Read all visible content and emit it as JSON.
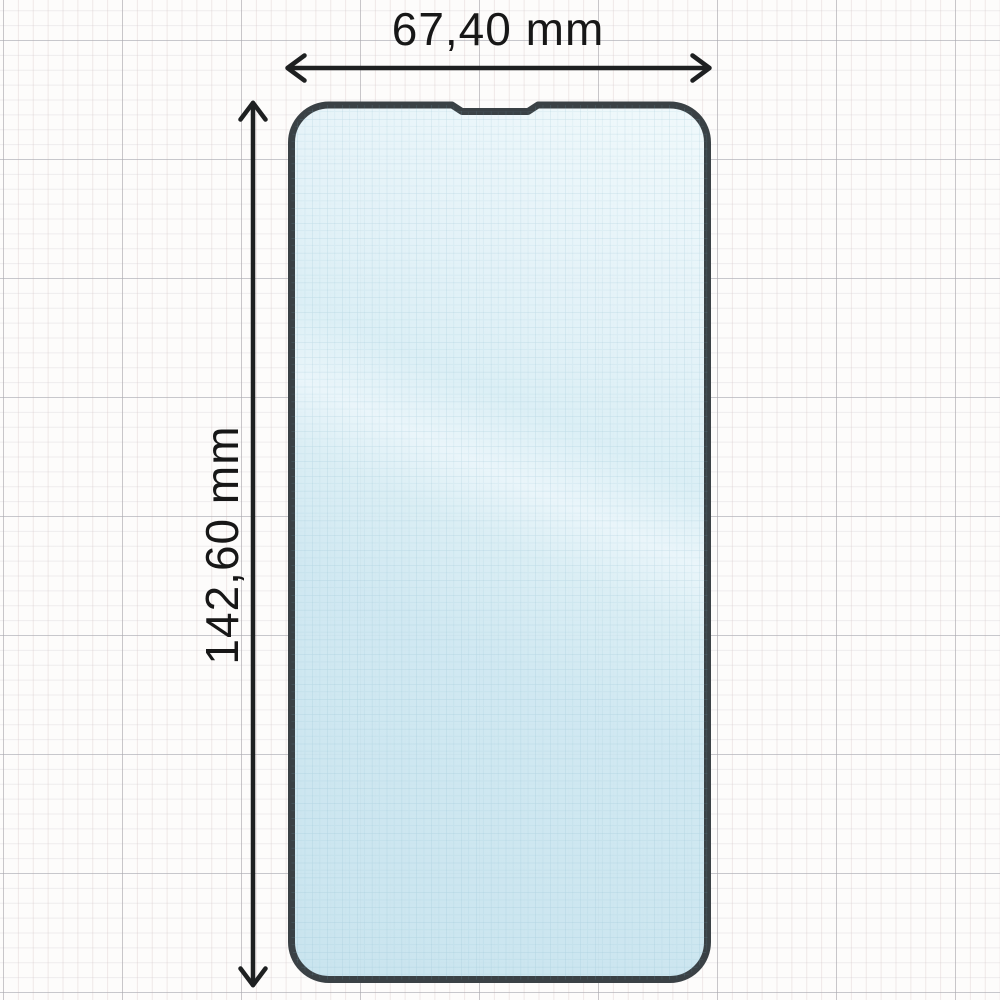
{
  "diagram": {
    "width_label": "67,40 mm",
    "height_label": "142,60 mm"
  },
  "colors": {
    "paper": "#fdfcfb",
    "grid_minor_pink": "#efe4e3",
    "grid_major_gray": "#c8c9cc",
    "glass_fill": "#cde7f1",
    "glass_sheen": "#e9f5fa",
    "glass_border": "#3a4145",
    "dimension_line": "#1e2021",
    "label_text": "#171717"
  }
}
